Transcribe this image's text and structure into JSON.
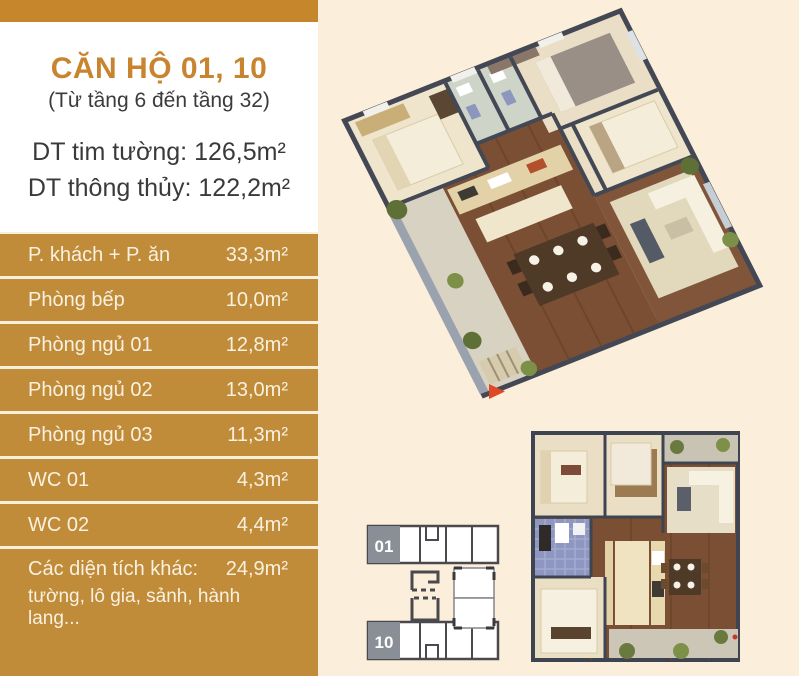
{
  "header": {
    "title": "CĂN HỘ 01, 10",
    "subtitle": "(Từ tầng 6 đến tầng 32)"
  },
  "metrics": [
    {
      "label": "DT tim tường:",
      "value": "126,5m²"
    },
    {
      "label": "DT thông thủy:",
      "value": "122,2m²"
    }
  ],
  "table": {
    "rows": [
      {
        "label": "P. khách + P. ăn",
        "value": "33,3m²"
      },
      {
        "label": "Phòng bếp",
        "value": "10,0m²"
      },
      {
        "label": "Phòng ngủ 01",
        "value": "12,8m²"
      },
      {
        "label": "Phòng ngủ 02",
        "value": "13,0m²"
      },
      {
        "label": "Phòng ngủ 03",
        "value": "11,3m²"
      },
      {
        "label": "WC 01",
        "value": "4,3m²"
      },
      {
        "label": "WC 02",
        "value": "4,4m²"
      },
      {
        "label": "Các diện tích khác:",
        "value": "24,9m²",
        "sublabel": "tường, lô gia, sảnh, hành lang..."
      }
    ]
  },
  "key_plan": {
    "unit_top": "01",
    "unit_bottom": "10"
  },
  "colors": {
    "band_orange": "#C6862C",
    "title_orange": "#C8842E",
    "row_gold": "#C18C3A",
    "row_text_cream": "#F8F1E0",
    "page_beige": "#FBEEDA",
    "wall_dark": "#434854",
    "wood_floor": "#7B4F33",
    "key_unit_gray": "#8A8E96",
    "entrance_arrow_red": "#DE4A26"
  }
}
